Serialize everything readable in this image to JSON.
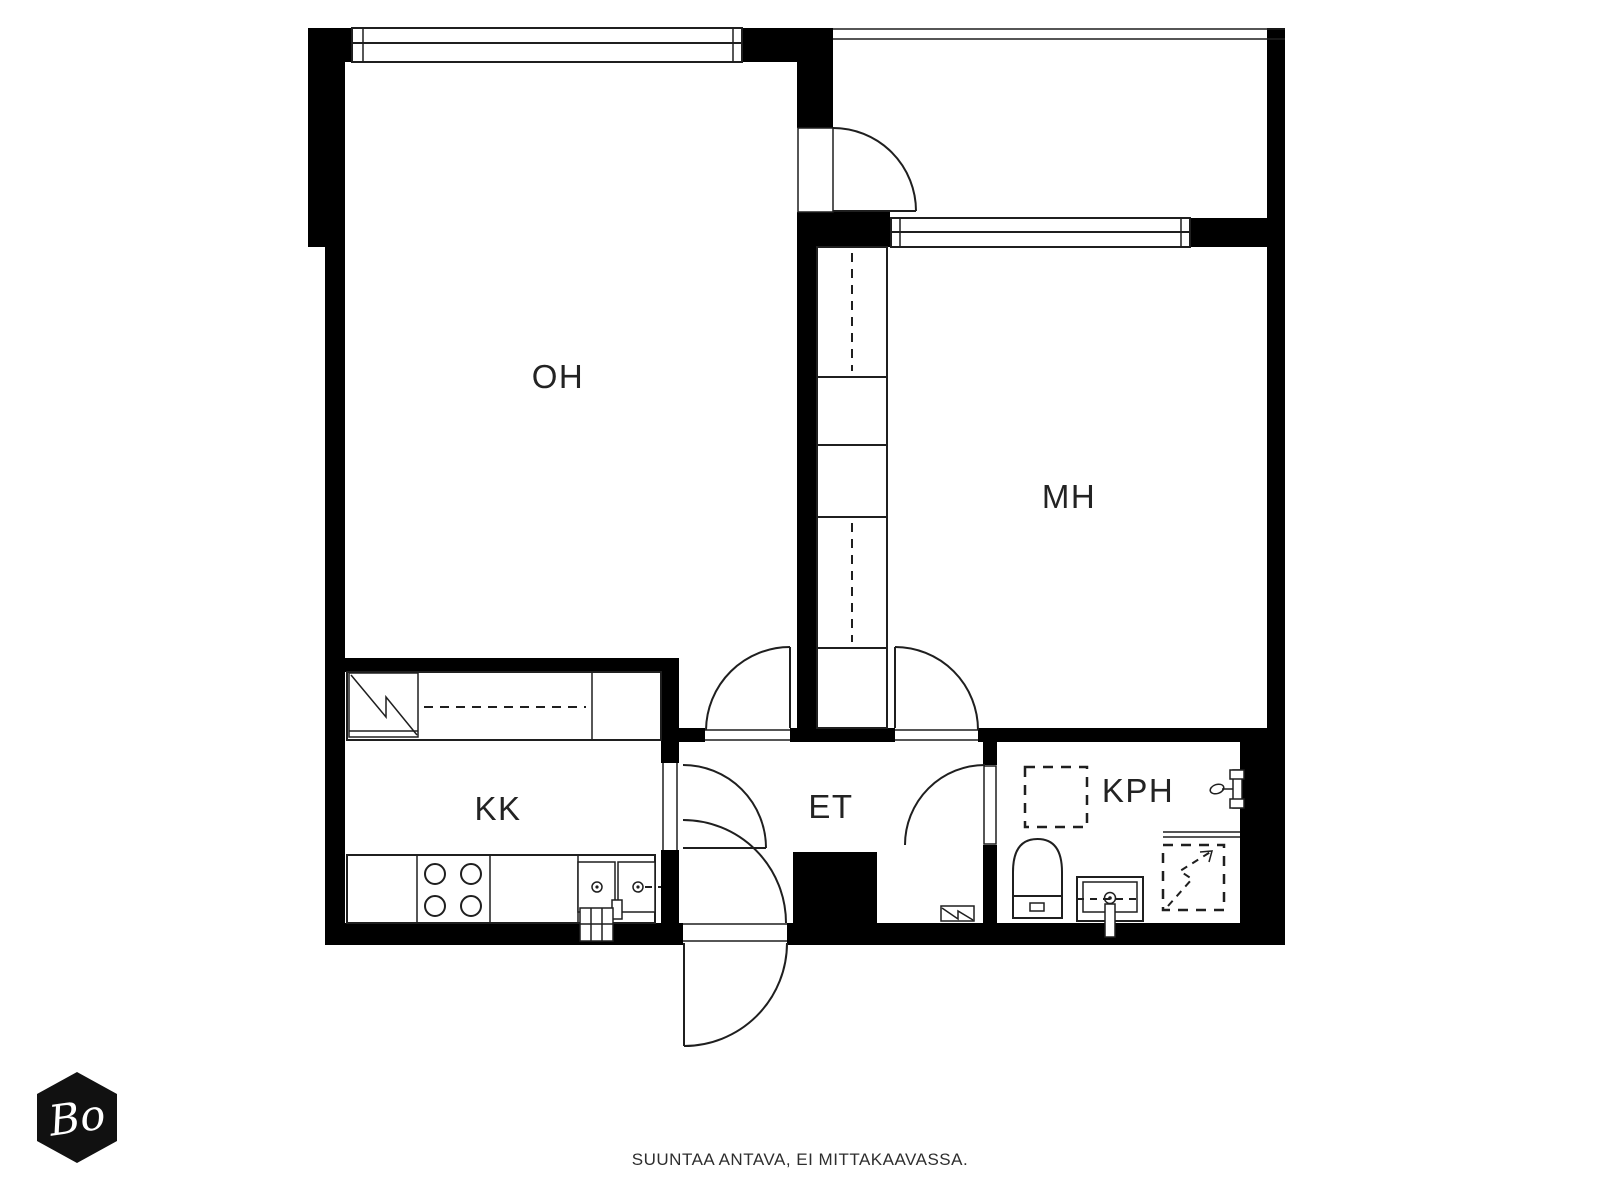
{
  "rooms": [
    {
      "id": "oh",
      "label": "OH"
    },
    {
      "id": "mh",
      "label": "MH"
    },
    {
      "id": "kk",
      "label": "KK"
    },
    {
      "id": "et",
      "label": "ET"
    },
    {
      "id": "kph",
      "label": "KPH"
    }
  ],
  "footer": {
    "note": "SUUNTAA ANTAVA, EI MITTAKAAVASSA."
  },
  "logo": {
    "text": "Bo"
  },
  "colors": {
    "wall": "#000000",
    "line": "#1f1f1f",
    "background": "#ffffff",
    "label": "#232323",
    "logo_background": "#111111",
    "logo_text": "#ffffff"
  },
  "fixtures": [
    "window-icon",
    "balcony-door-swing-icon",
    "wardrobe-column-icon",
    "fridge-icon",
    "kitchen-counter-icon",
    "stove-burners-icon",
    "double-sink-icon",
    "wall-vent-icon",
    "entrance-door-swing-icon",
    "radiator-icon",
    "toilet-icon",
    "washbasin-icon",
    "shower-rail-icon",
    "shower-mixer-icon",
    "shower-drain-arrow-icon",
    "washing-machine-reservation-icon"
  ]
}
